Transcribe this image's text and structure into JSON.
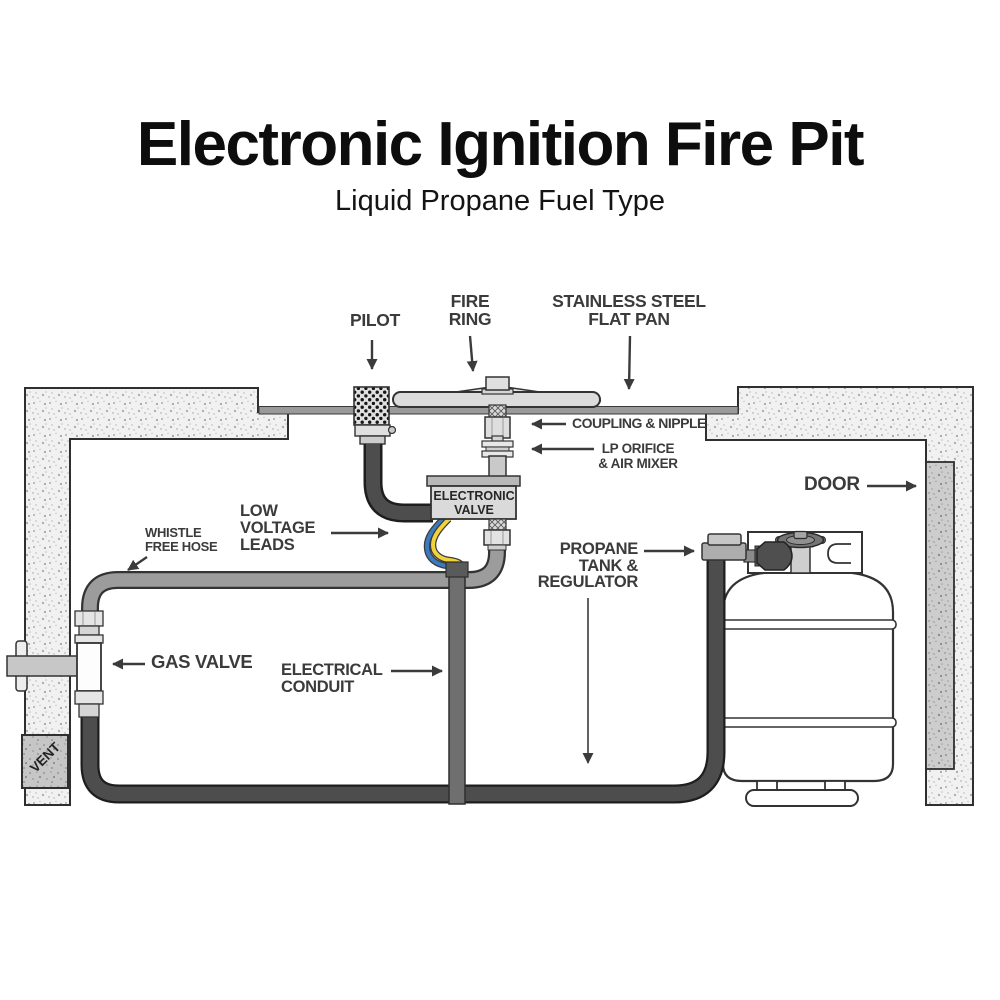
{
  "title": "Electronic Ignition Fire Pit",
  "subtitle": "Liquid Propane Fuel Type",
  "labels": {
    "pilot": "PILOT",
    "fire_ring": "FIRE\nRING",
    "flat_pan": "STAINLESS STEEL\nFLAT PAN",
    "coupling_nipple": "COUPLING & NIPPLE",
    "lp_orifice": "LP ORIFICE\n& AIR MIXER",
    "door": "DOOR",
    "electronic_valve": "ELECTRONIC\nVALVE",
    "low_voltage_leads": "LOW\nVOLTAGE\nLEADS",
    "whistle_free_hose": "WHISTLE\nFREE HOSE",
    "gas_valve": "GAS VALVE",
    "electrical_conduit": "ELECTRICAL\nCONDUIT",
    "propane_tank": "PROPANE\nTANK &\nREGULATOR",
    "vent": "VENT"
  },
  "colors": {
    "title_text": "#0d0d0d",
    "label_text": "#3b3b3b",
    "hose_gray": "#9c9c9c",
    "hose_dark": "#4d4d4d",
    "conduit_gray": "#6f6f6f",
    "wire_blue": "#3a7abf",
    "wire_yellow": "#f2d23a",
    "valve_fill": "#dadada",
    "wall_fill": "#f1f1f1",
    "door_fill": "#cdcdcd"
  }
}
